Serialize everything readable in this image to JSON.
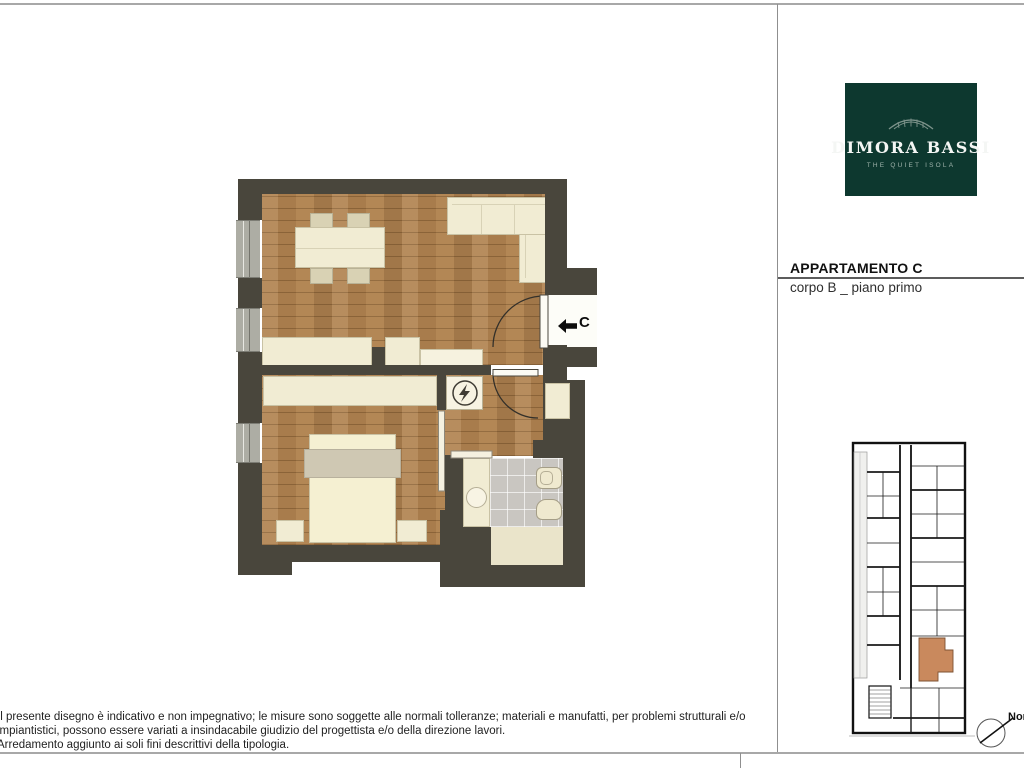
{
  "logo": {
    "brand": "DIMORA BASSI",
    "tagline": "THE QUIET ISOLA",
    "bg_color": "#0d382f",
    "icon": "awning-icon"
  },
  "header": {
    "title": "APPARTAMENTO C",
    "subtitle": "corpo B _ piano primo"
  },
  "floorplan": {
    "entrance_label": "C",
    "entrance_arrow_icon": "arrow-left-icon",
    "electrical_panel_icon": "lightning-icon",
    "rooms": [
      "soggiorno/cucina",
      "camera",
      "bagno",
      "disimpegno"
    ],
    "colors": {
      "wall": "#49463c",
      "wood_floor": "#b18350",
      "furniture": "#f1ecd3",
      "bathroom_tile": "#c9c6c1"
    }
  },
  "keyplan": {
    "highlight_color": "#c9895d",
    "compass_label": "Nord"
  },
  "footer": {
    "lines": [
      "Il presente disegno è indicativo e non impegnativo; le misure sono soggette alle normali tolleranze; materiali e manufatti, per problemi strutturali e/o",
      "impiantistici, possono essere variati a insindacabile giudizio del progettista e/o della direzione lavori.",
      "Arredamento aggiunto ai soli fini descrittivi della tipologia."
    ]
  }
}
